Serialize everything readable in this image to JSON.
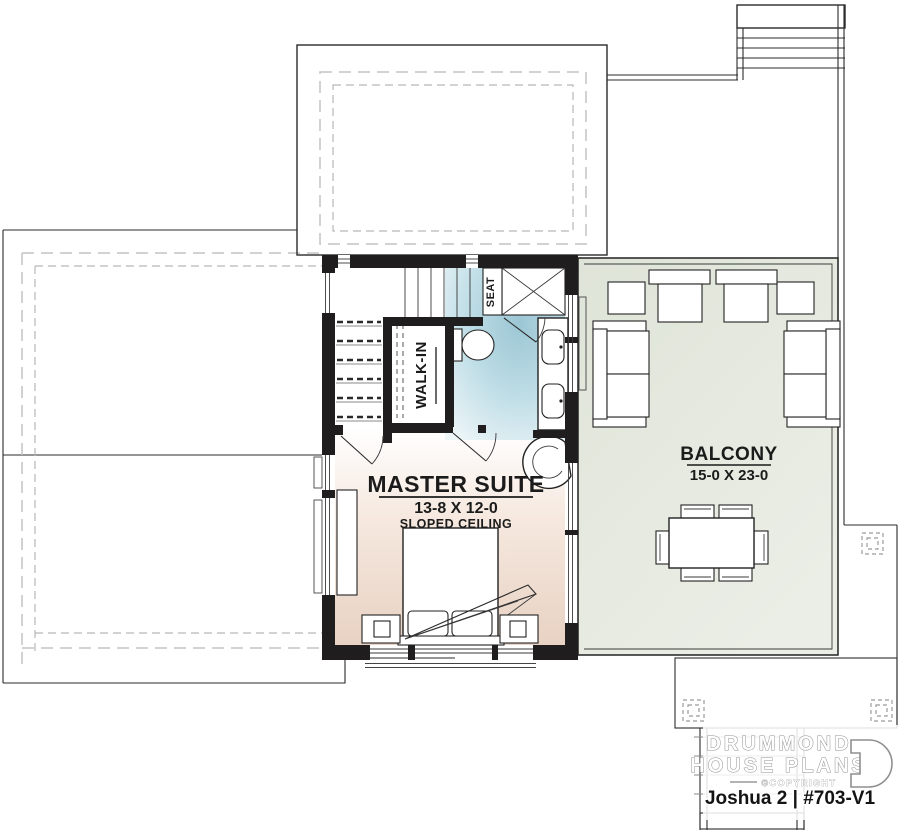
{
  "document": {
    "type": "floor-plan",
    "labels": {
      "master_suite": {
        "title": "MASTER SUITE",
        "dimensions": "13-8 X 12-0",
        "note": "SLOPED CEILING"
      },
      "balcony": {
        "title": "BALCONY",
        "dimensions": "15-0 X 23-0"
      },
      "walk_in": "WALK-IN",
      "seat": "SEAT"
    },
    "branding": {
      "company_line1": "DRUMMOND",
      "company_line2": "HOUSE PLANS",
      "copyright": "©COPYRIGHT",
      "plan_title": "Joshua 2 | #703-V1"
    },
    "colors": {
      "wall": "#201d1e",
      "bedroom_floor": "#e8d2c3",
      "bathroom_floor": "#a8cfdc",
      "balcony_floor": "#e2e6dd",
      "logo_gray": "#8f8f8f"
    }
  }
}
